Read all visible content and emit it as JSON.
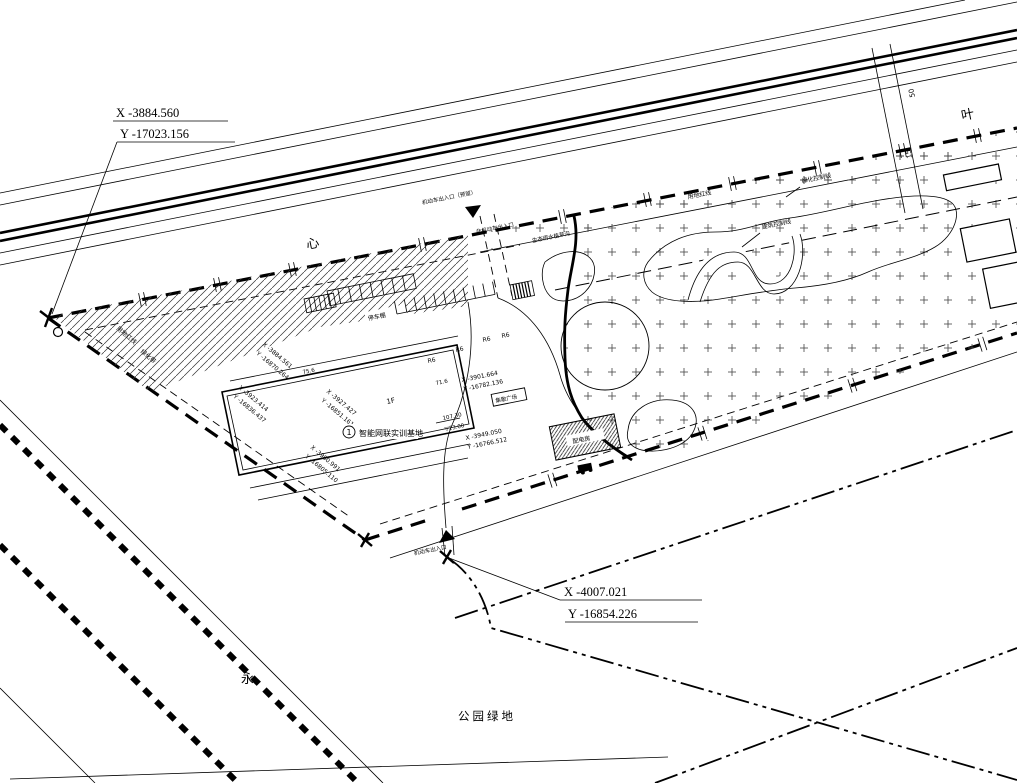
{
  "callouts": {
    "top_left": {
      "x": "X -3884.560",
      "y": "Y -17023.156"
    },
    "bottom": {
      "x": "X -4007.021",
      "y": "Y -16854.226"
    }
  },
  "corner_coords": [
    {
      "x": "X -3884.561",
      "y": "Y -16870.264"
    },
    {
      "x": "X -3923.414",
      "y": "Y -16836.437"
    },
    {
      "x": "X -3927.427",
      "y": "Y -16851.161"
    },
    {
      "x": "X -3980.991",
      "y": "Y -16805.110"
    },
    {
      "x": "X -3901.664",
      "y": "Y -16782.136"
    },
    {
      "x": "X -3949.050",
      "y": "Y -16766.512"
    }
  ],
  "site": {
    "bubble_number": "1",
    "name": "智能网联实训基地",
    "floor": "1F",
    "shed_label": "停车棚",
    "guard_label": "配电房",
    "plaza_label": "集散广场",
    "elev_value": "107.30",
    "elev_level": "▽23.00",
    "dim_a": "71.6",
    "dim_b": "75.6",
    "radius_label": "R6"
  },
  "boundaries": {
    "red_line": "用地红线",
    "green_control": "绿化控制线",
    "building_control": "建筑控制线",
    "green_belt": "绿化带",
    "side_red_line": "用地红线"
  },
  "entrances": {
    "vehicle_reserved": "机动车出入口（预留）",
    "non_motor": "非机动车出入口",
    "vehicle_main": "机动车出入口",
    "swale": "生态雨水植草沟"
  },
  "roads": {
    "name_xin": "心",
    "name_ye": "叶",
    "name_yong": "永",
    "park_label": "公园绿地",
    "dim_width_a": "50",
    "dim_width_b": "15"
  }
}
